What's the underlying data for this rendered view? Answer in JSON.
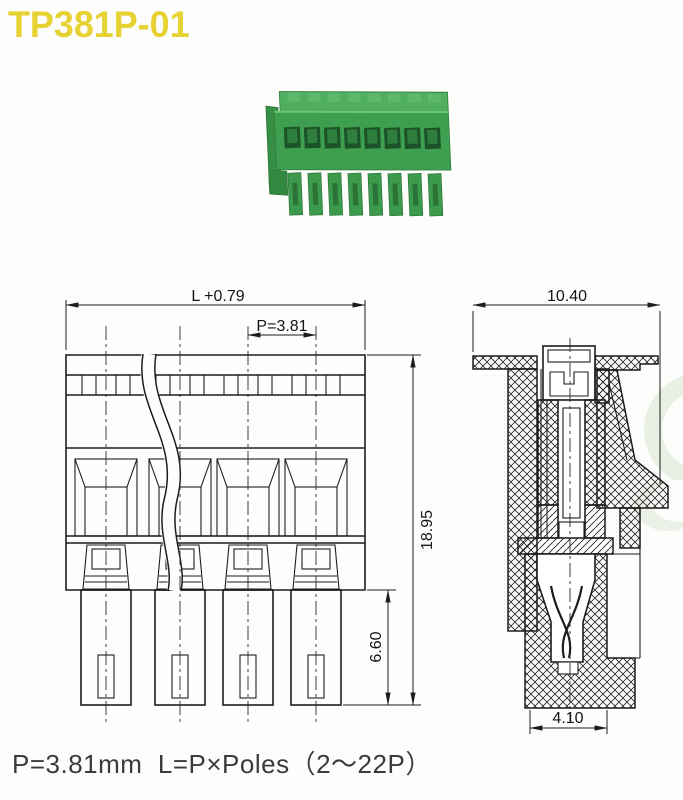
{
  "page": {
    "title": "TP381P-01",
    "footer_note": "P=3.81mm  L=P×Poles（2～22P）"
  },
  "front_view": {
    "dim_overall_width": "L +0.79",
    "dim_pitch": "P=3.81",
    "dim_total_height": "18.95",
    "dim_pin_length": "6.60"
  },
  "side_view": {
    "dim_overall_depth": "10.40",
    "dim_bottom_width": "4.10"
  },
  "colors": {
    "title_yellow": "#e6d232",
    "connector_green": "#3f9f50",
    "connector_green_dark": "#1c5227",
    "connector_green_mid": "#2e7f3e",
    "connector_green_light": "#5cb86b",
    "drawing_line": "#1d1d1d",
    "footer_text": "#3b3b3b",
    "watermark_green": "#e3ecdd"
  }
}
